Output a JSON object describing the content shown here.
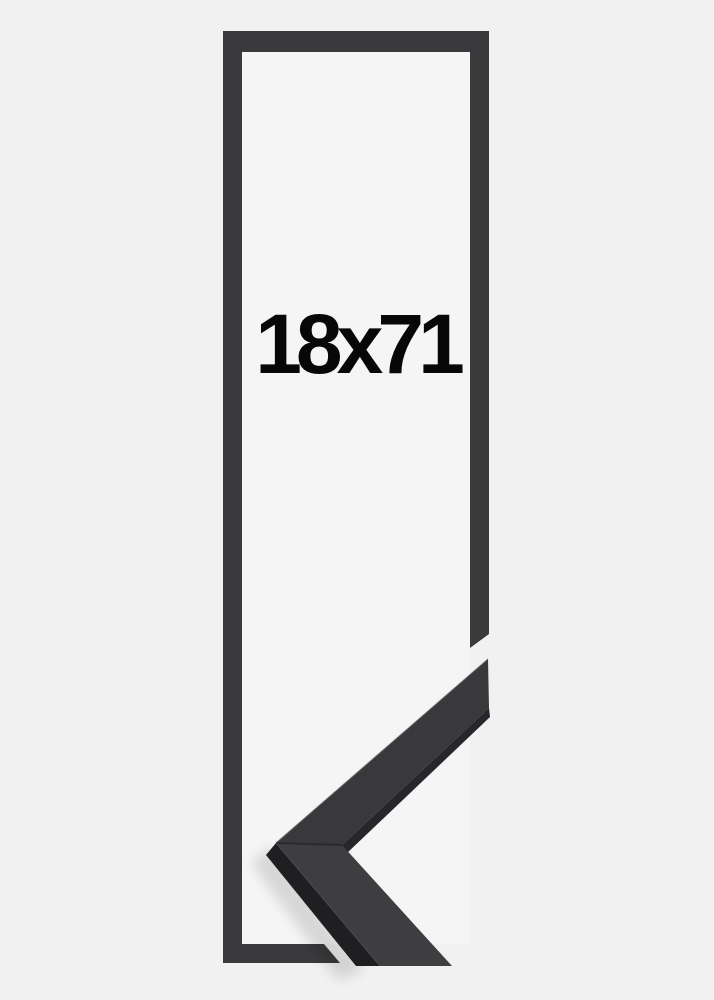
{
  "size_label": "18x71",
  "colors": {
    "background": "#f1f1f2",
    "frame_opening": "#f5f5f6",
    "frame": "#3a3a3c",
    "sample_top_upper": "#39393b",
    "sample_top_lower": "#3e3e41",
    "sample_side_dark": "#1f1f22",
    "sample_side_medium": "#27272b",
    "seam": "#2b2b2e",
    "edge_highlight": "#55555a",
    "shadow": "#000000",
    "label_text": "#070707"
  }
}
